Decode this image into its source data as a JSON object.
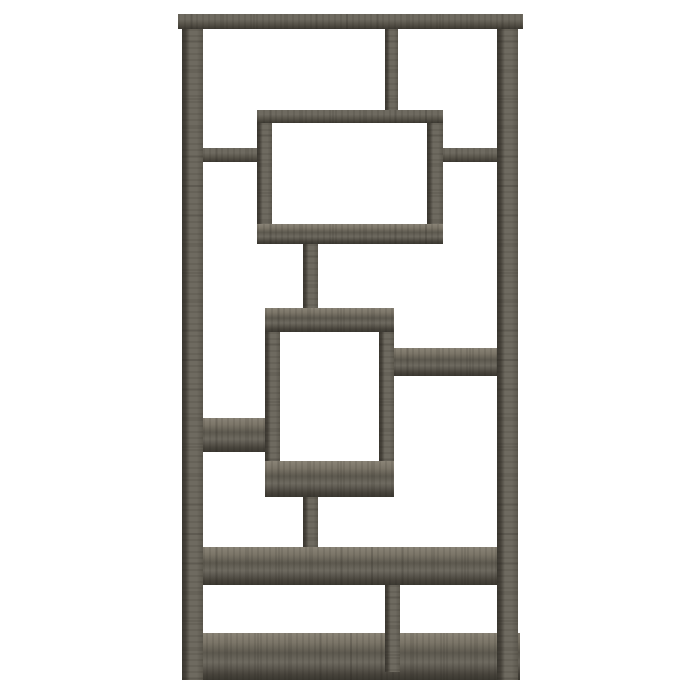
{
  "scene": {
    "description": "Product photo of a tall geometric bookcase (interlocking rectangle open shelves) in weathered grey woodgrain, centered on a plain white background",
    "colors": {
      "bg": "#ffffff",
      "face": "#6e6a60",
      "face-dim": "#5d594f",
      "top-face": "#8a8477",
      "edge-dark": "#47433b",
      "deep": "#3b3831",
      "grain": "rgba(28,25,20,0.10)"
    }
  },
  "furniture": {
    "type": "bookcase",
    "style": "geometric interlocking rectangles, 10 open shelves",
    "finish": "weathered grey woodgrain",
    "parts": [
      {
        "name": "top-board",
        "kind": "horizontal",
        "x": 178,
        "y": 14,
        "w": 345,
        "h": 15
      },
      {
        "name": "bottom-board",
        "kind": "horizontal-top-visible",
        "x": 182,
        "y": 633,
        "w": 338,
        "h": 47
      },
      {
        "name": "left-post",
        "kind": "vertical",
        "x": 182,
        "y": 29,
        "w": 21,
        "h": 651
      },
      {
        "name": "right-post",
        "kind": "vertical",
        "x": 497,
        "y": 29,
        "w": 21,
        "h": 651
      },
      {
        "name": "top-divider",
        "kind": "vertical",
        "x": 385,
        "y": 29,
        "w": 13,
        "h": 81
      },
      {
        "name": "upper-box-top-shelf",
        "kind": "horizontal",
        "x": 257,
        "y": 110,
        "w": 186,
        "h": 13
      },
      {
        "name": "upper-box-left-wall",
        "kind": "vertical",
        "x": 257,
        "y": 123,
        "w": 15,
        "h": 101
      },
      {
        "name": "upper-box-right-wall",
        "kind": "vertical",
        "x": 427,
        "y": 123,
        "w": 16,
        "h": 101
      },
      {
        "name": "upper-box-bottom-shelf",
        "kind": "horizontal-top-visible",
        "x": 257,
        "y": 224,
        "w": 186,
        "h": 20
      },
      {
        "name": "upper-left-shelf",
        "kind": "horizontal",
        "x": 203,
        "y": 148,
        "w": 54,
        "h": 14
      },
      {
        "name": "upper-right-shelf",
        "kind": "horizontal",
        "x": 443,
        "y": 148,
        "w": 54,
        "h": 14
      },
      {
        "name": "upper-center-stem",
        "kind": "vertical",
        "x": 303,
        "y": 244,
        "w": 15,
        "h": 64
      },
      {
        "name": "lower-box-top-shelf",
        "kind": "horizontal-top-visible",
        "x": 265,
        "y": 308,
        "w": 129,
        "h": 24
      },
      {
        "name": "lower-box-left-wall",
        "kind": "vertical",
        "x": 265,
        "y": 332,
        "w": 15,
        "h": 129
      },
      {
        "name": "lower-box-right-wall",
        "kind": "vertical",
        "x": 379,
        "y": 332,
        "w": 15,
        "h": 129
      },
      {
        "name": "lower-box-bottom-shelf",
        "kind": "horizontal-top-visible",
        "x": 265,
        "y": 461,
        "w": 129,
        "h": 36
      },
      {
        "name": "middle-right-shelf",
        "kind": "horizontal-top-visible",
        "x": 394,
        "y": 348,
        "w": 103,
        "h": 28
      },
      {
        "name": "middle-left-shelf",
        "kind": "horizontal-top-visible",
        "x": 203,
        "y": 418,
        "w": 62,
        "h": 34
      },
      {
        "name": "lower-center-stem",
        "kind": "vertical",
        "x": 303,
        "y": 497,
        "w": 15,
        "h": 50
      },
      {
        "name": "wide-lower-shelf",
        "kind": "horizontal-top-visible",
        "x": 203,
        "y": 547,
        "w": 294,
        "h": 38
      },
      {
        "name": "bottom-divider",
        "kind": "vertical",
        "x": 385,
        "y": 585,
        "w": 15,
        "h": 87
      }
    ]
  }
}
